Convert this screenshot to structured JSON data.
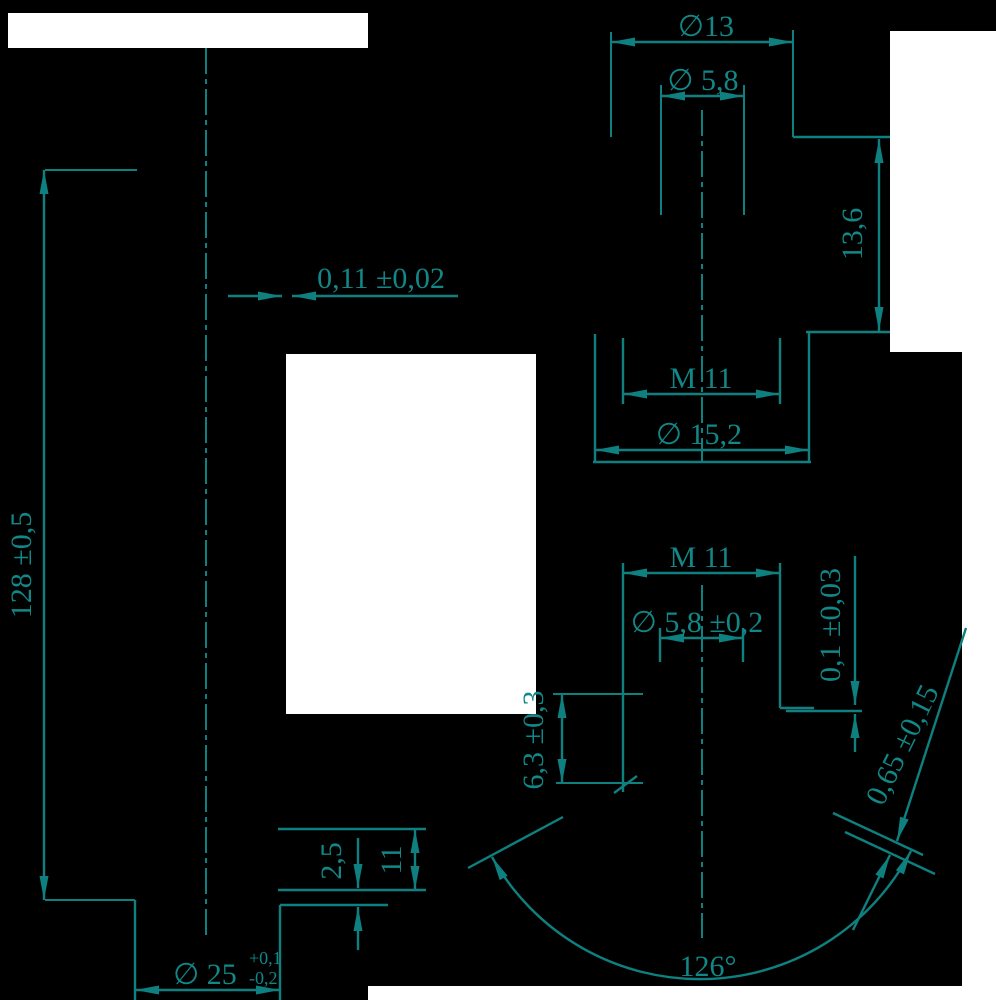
{
  "drawing": {
    "type": "engineering-dimension-drawing",
    "colors": {
      "line": "#0e8080",
      "background": "#000000",
      "paper_patches": "#ffffff"
    },
    "dimensions": {
      "dia13": "∅13",
      "dia58_top": "∅ 5,8",
      "len136": "13,6",
      "gap011": "0,11 ±0,02",
      "m11_top": "M 11",
      "dia152": "∅ 15,2",
      "len128": "128 ±0,5",
      "m11_bottom": "M 11",
      "dia58_tol": "∅ 5,8 ±0,2",
      "gap01": "0,1 ±0,03",
      "len63": "6,3 ±0,3",
      "chamfer065": "0,65 ±0,15",
      "len25": "2,5",
      "len11": "11",
      "dia25": "∅ 25",
      "dia25_tol_plus": "+0,1",
      "dia25_tol_minus": "-0,2",
      "angle126": "126°"
    }
  }
}
